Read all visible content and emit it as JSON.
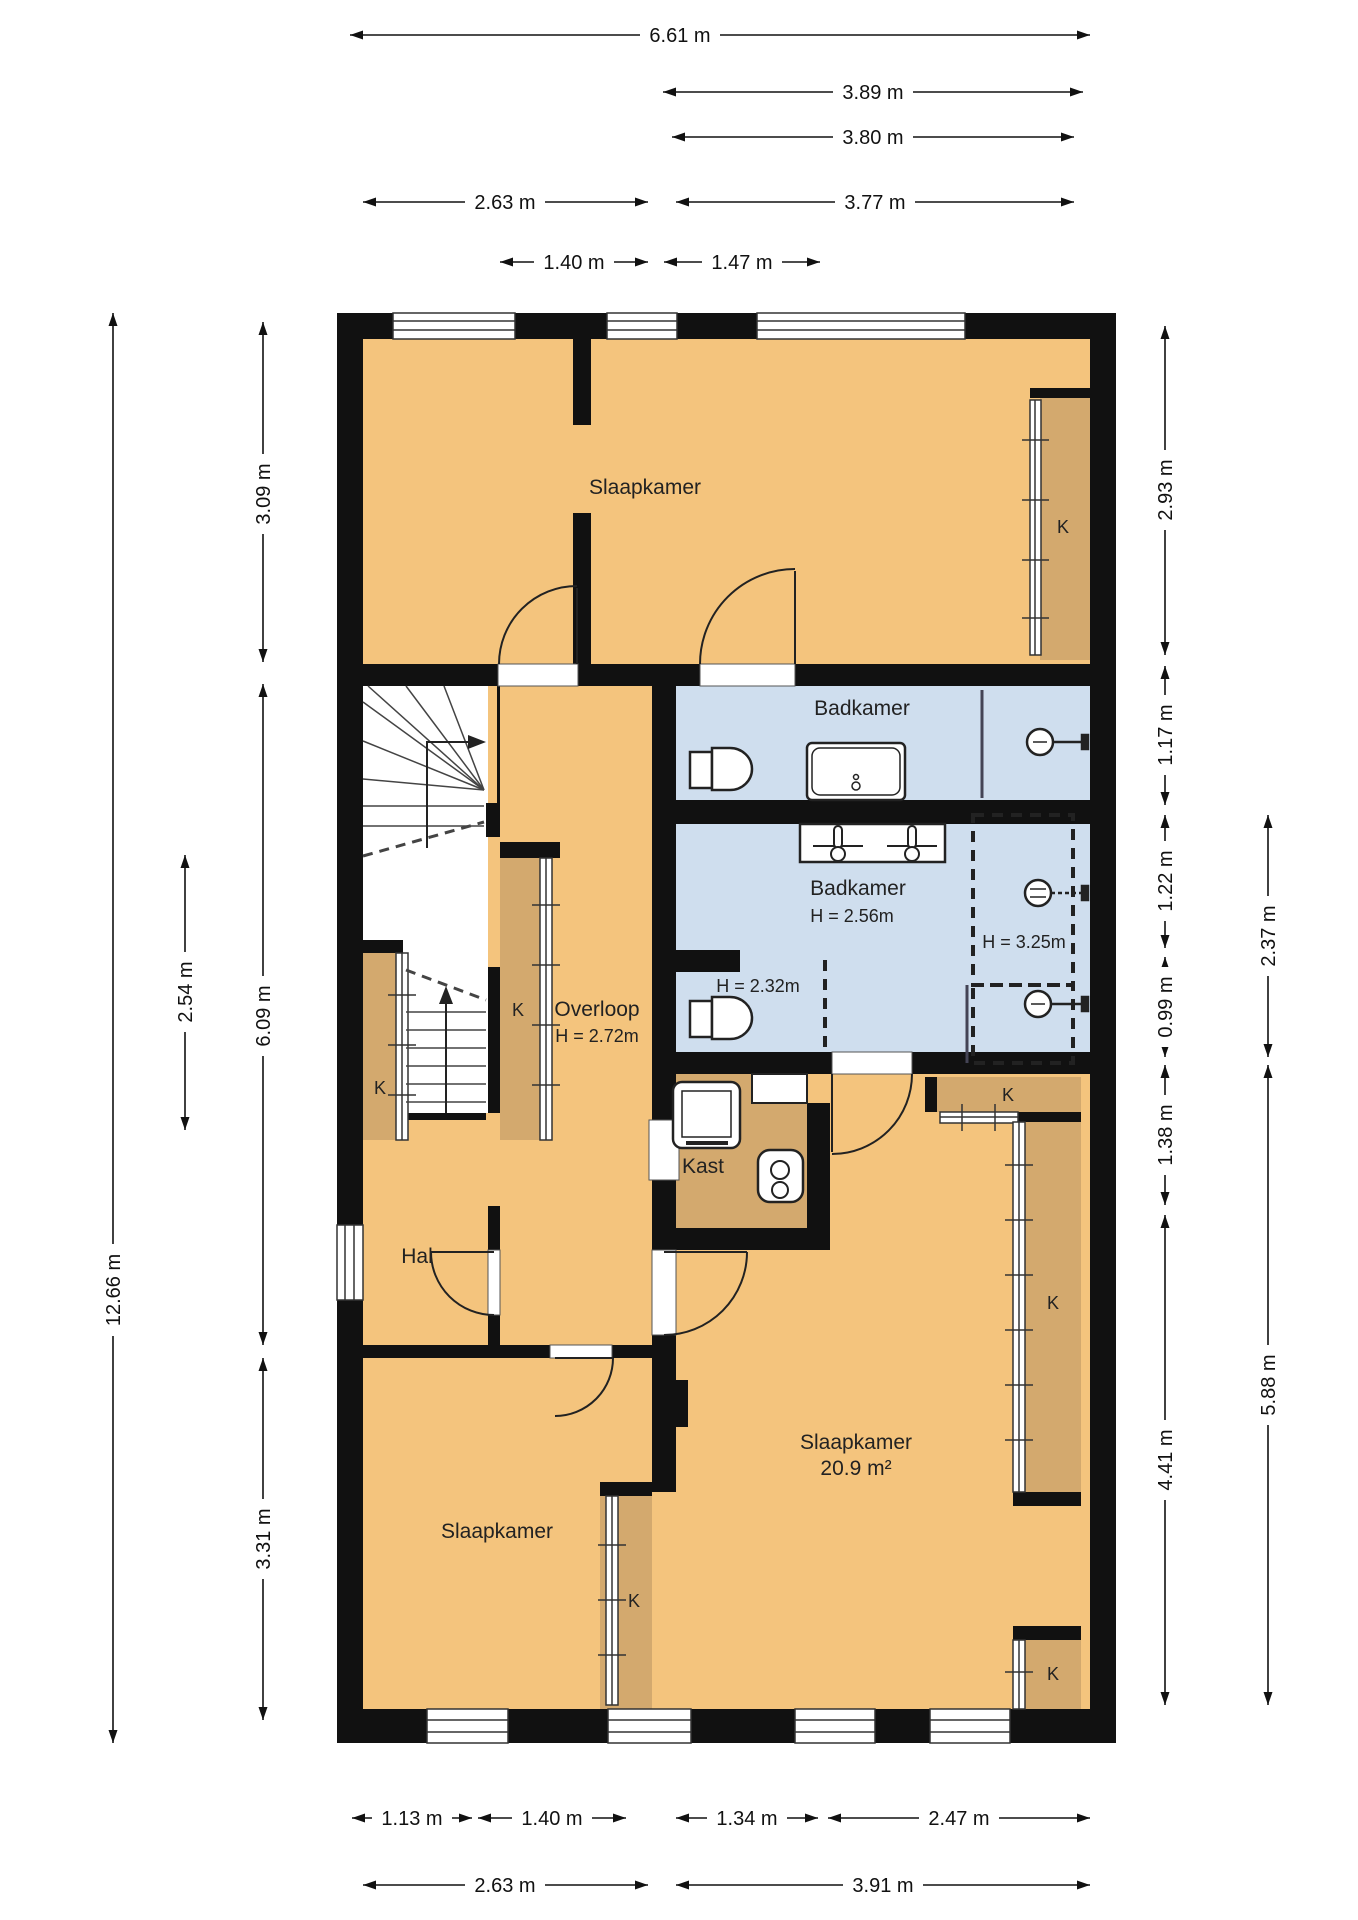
{
  "plan_type": "floor-plan",
  "colors": {
    "room_fill": "#f4c47d",
    "closet_fill": "#d3a96e",
    "bathroom_fill": "#cfdeee",
    "wall": "#111111",
    "background": "#ffffff"
  },
  "rooms": {
    "bedroom_top": {
      "label": "Slaapkamer"
    },
    "bathroom_top": {
      "label": "Badkamer"
    },
    "bathroom_mid": {
      "label": "Badkamer",
      "height": "H = 2.56m"
    },
    "wc_niche": {
      "height": "H = 2.32m"
    },
    "shower_zone": {
      "height": "H = 3.25m"
    },
    "landing": {
      "label": "Overloop",
      "height": "H = 2.72m"
    },
    "closet_room": {
      "label": "Kast"
    },
    "hall": {
      "label": "Hal"
    },
    "bedroom_right": {
      "label": "Slaapkamer",
      "area": "20.9 m²"
    },
    "bedroom_bottom": {
      "label": "Slaapkamer"
    }
  },
  "closet_marks": [
    "K",
    "K",
    "K",
    "K",
    "K",
    "K",
    "K"
  ],
  "dimensions": {
    "top": [
      "6.61 m",
      "3.89 m",
      "3.80 m",
      "2.63 m",
      "3.77 m",
      "1.40 m",
      "1.47 m"
    ],
    "bottom": [
      "1.13 m",
      "1.40 m",
      "1.34 m",
      "2.47 m",
      "2.63 m",
      "3.91 m"
    ],
    "left": [
      "12.66 m",
      "2.54 m",
      "3.09 m",
      "6.09 m",
      "3.31 m"
    ],
    "right": [
      "2.93 m",
      "1.17 m",
      "1.22 m",
      "0.99 m",
      "1.38 m",
      "4.41 m",
      "2.37 m",
      "5.88 m"
    ]
  }
}
